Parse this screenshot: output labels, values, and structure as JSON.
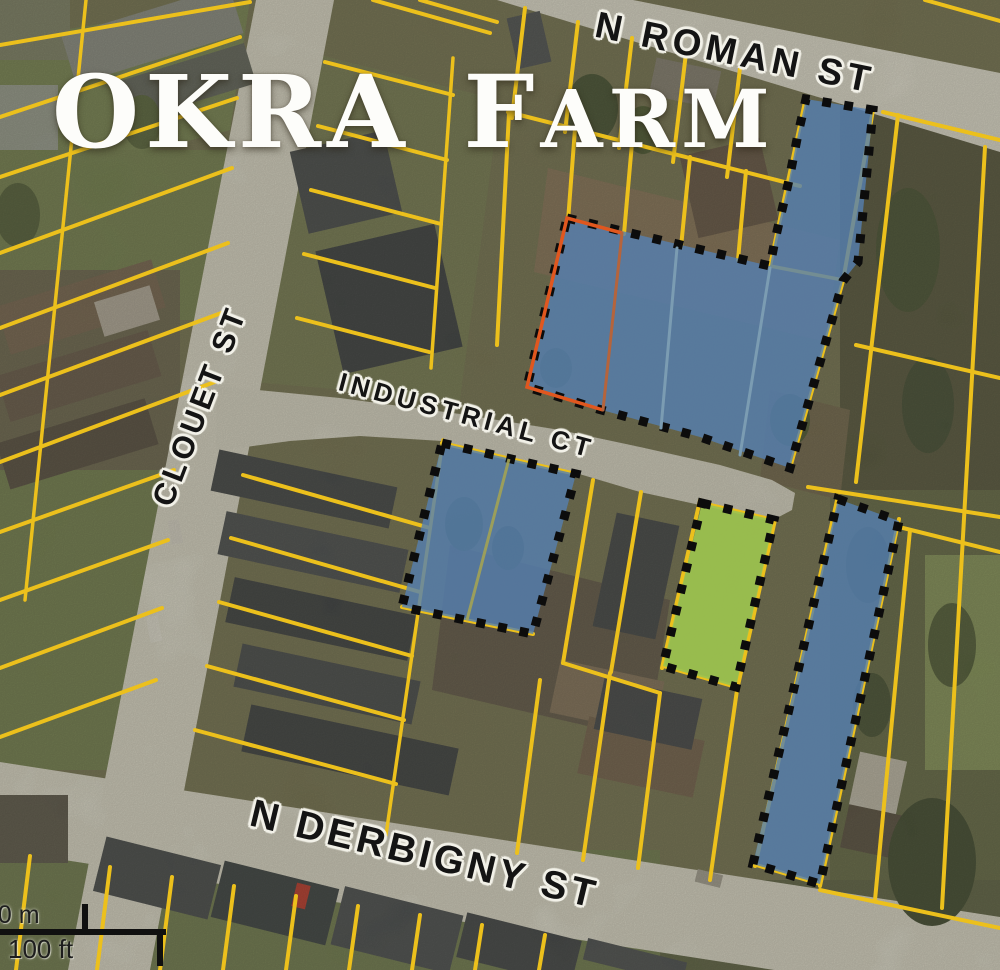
{
  "title": {
    "prefix": "OKRA F",
    "smallcaps": "ARM"
  },
  "streets": {
    "n_roman": "N ROMAN ST",
    "clouet": "CLOUET ST",
    "industrial": "INDUSTRIAL CT",
    "n_derbigny": "N DERBIGNY ST"
  },
  "scale_bar": {
    "meters": "30 m",
    "feet": "100 ft"
  },
  "palette": {
    "parcel_line": "#ecc01c",
    "highlight_blue": "#5580b2",
    "highlight_green": "#9cc34f",
    "boundary_dots": "#0c0c0c",
    "boundary_orange": "#e0571f",
    "street_gray": "#d3d1c4"
  }
}
